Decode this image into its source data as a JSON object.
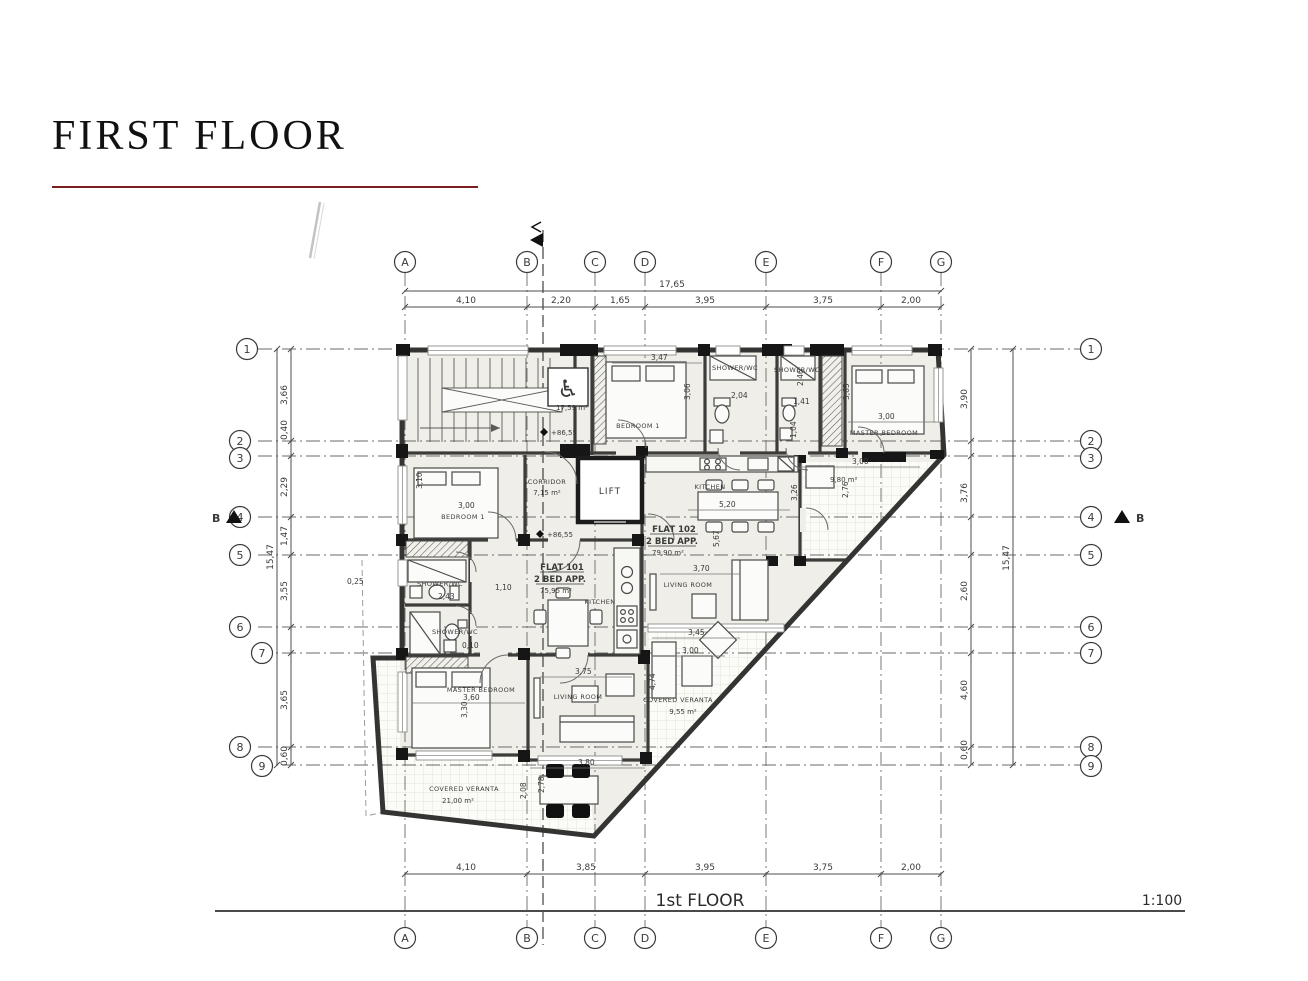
{
  "title": "FIRST FLOOR",
  "footer": {
    "label": "1st FLOOR",
    "scale": "1:100"
  },
  "grid": {
    "letters": [
      "A",
      "B",
      "C",
      "D",
      "E",
      "F",
      "G"
    ],
    "numbers": [
      "1",
      "2",
      "3",
      "4",
      "5",
      "6",
      "7",
      "8",
      "9"
    ]
  },
  "dims": {
    "top_total": "17,65",
    "top": [
      "4,10",
      "2,20",
      "1,65",
      "3,95",
      "3,75",
      "2,00"
    ],
    "bottom": [
      "4,10",
      "3,85",
      "3,95",
      "3,75",
      "2,00"
    ],
    "left": [
      "3,66",
      "0,40",
      "2,29",
      "1,47",
      "3,55",
      "3,65",
      "0,60"
    ],
    "left_total": "15,47",
    "right": [
      "3,90",
      "3,76",
      "2,60",
      "4,60",
      "0,60"
    ],
    "right_total": "15,47",
    "offset": "0,25"
  },
  "section": {
    "left": "B",
    "right": "B"
  },
  "levels": {
    "stair": "+86,55",
    "hall": "+86,55"
  },
  "rooms": {
    "stair_area": "17,59 m²",
    "corridor": {
      "name": "CORRIDOR",
      "area": "7,15 m²"
    },
    "lift": "LIFT",
    "flat102": {
      "name": "FLAT 102",
      "type": "2 BED APP.",
      "area": "79,90 m²",
      "kitchen": "KITCHEN",
      "living": "LIVING ROOM",
      "bedroom": "BEDROOM 1",
      "master": "MASTER BEDROOM",
      "shower1": "SHOWER/WC",
      "shower2": "SHOWER/WC",
      "balcony_area": "9,80 m²"
    },
    "flat101": {
      "name": "FLAT 101",
      "type": "2 BED APP.",
      "area": "75,95 m²",
      "kitchen": "KITCHEN",
      "living": "LIVING ROOM",
      "bedroom": "BEDROOM 1",
      "master": "MASTER BEDROOM",
      "shower1": "SHOWER/WC",
      "shower2": "SHOWER/WC"
    },
    "veranda1": {
      "name": "COVERED VERANTA",
      "area": "21,00 m²"
    },
    "veranda2": {
      "name": "COVERED VERANTA",
      "area": "9,55 m²"
    }
  },
  "plan_dims": {
    "d1": "3,47",
    "d2": "3,06",
    "d3": "2,04",
    "d4": "1,41",
    "d5": "2,46",
    "d6": "3,65",
    "d7": "3,00",
    "d8": "1,04",
    "d9": "3,00",
    "d10": "2,76",
    "d11": "3,10",
    "d12": "3,00",
    "d13": "5,20",
    "d14": "3,26",
    "d15": "5,67",
    "d16": "3,70",
    "d17": "2,43",
    "d18": "1,10",
    "d19": "0,10",
    "d20": "3,45",
    "d21": "3,00",
    "d22": "3,75",
    "d23": "3,60",
    "d24": "3,30",
    "d25": "3,80",
    "d26": "2,08",
    "d27": "2,78",
    "d28": "4,74"
  }
}
